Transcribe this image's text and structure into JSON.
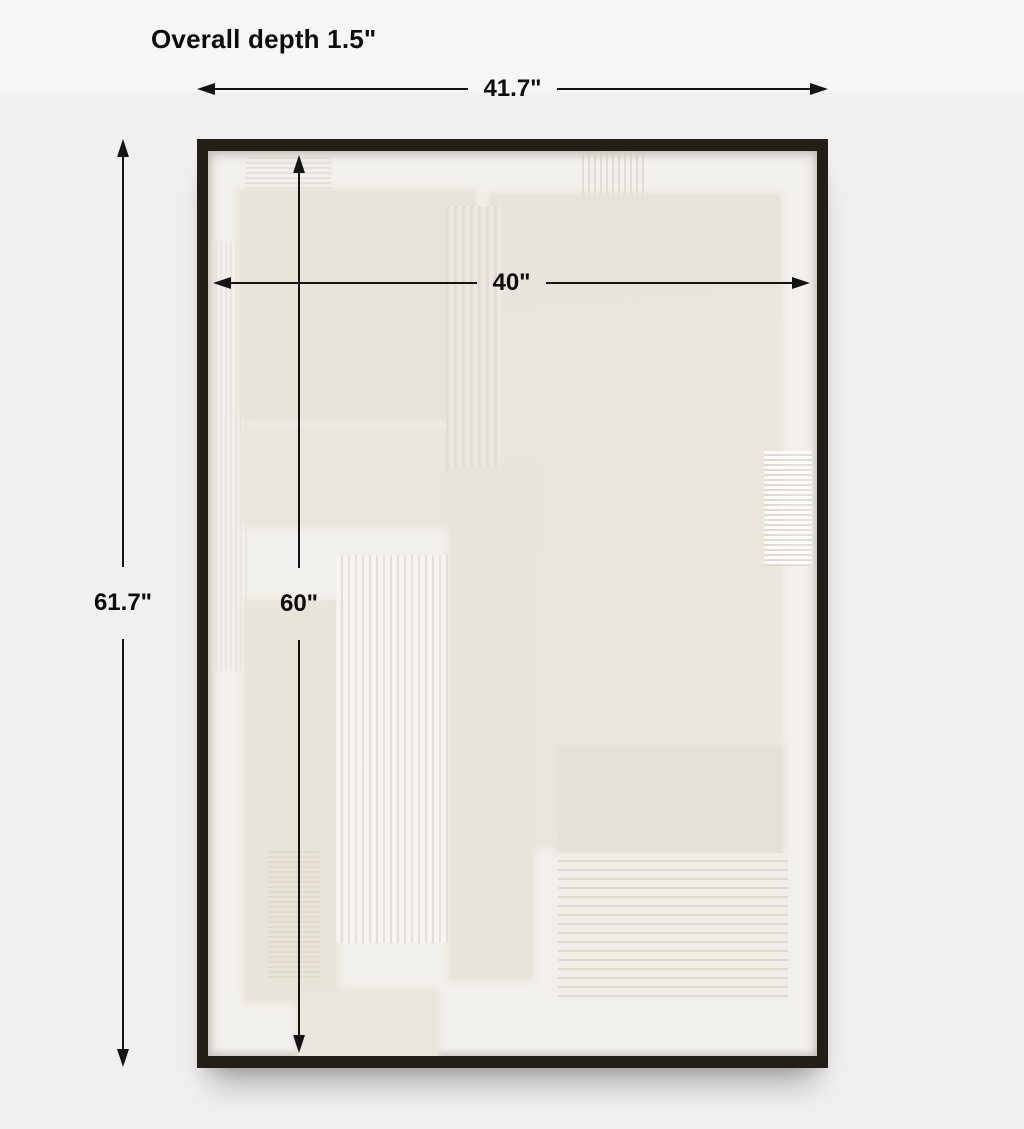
{
  "title": {
    "depth_note": "Overall depth 1.5\""
  },
  "dimensions": {
    "outer_width": "41.7\"",
    "outer_height": "61.7\"",
    "inner_width": "40\"",
    "inner_height": "60\""
  },
  "colors": {
    "page-bg": "#f1f0ee",
    "header-bg": "#f6f6f5",
    "text": "#0c0c0c",
    "dim-line": "#141414",
    "frame": "#241e18",
    "canvas": "#f2f0ec"
  }
}
